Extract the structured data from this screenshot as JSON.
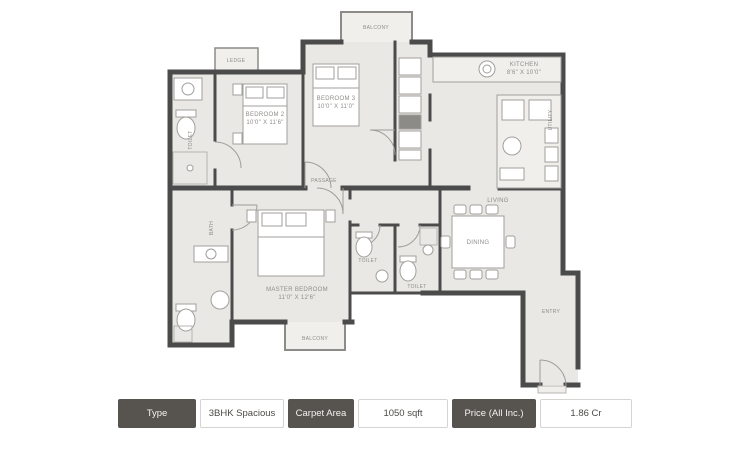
{
  "colors": {
    "wall": "#4b4b4b",
    "floor": "#e9e8e5",
    "balcony_floor": "#f0efec",
    "spec_cell_dark": "#57534f"
  },
  "plan": {
    "labels": {
      "balcony_top": "BALCONY",
      "ledge": "LEDGE",
      "bedroom2": {
        "name": "BEDROOM 2",
        "dims": "10'0\" X 11'6\""
      },
      "bedroom3": {
        "name": "BEDROOM 3",
        "dims": "10'0\" X 11'0\""
      },
      "kitchen": {
        "name": "KITCHEN",
        "dims": "8'6\" X 10'0\""
      },
      "utility": "UTILITY",
      "toilet_left": "TOILET",
      "bath": "BATH",
      "passage": "PASSAGE",
      "master": {
        "name": "MASTER BEDROOM",
        "dims": "11'0\" X 12'6\""
      },
      "toilet1": "TOILET",
      "toilet2": "TOILET",
      "dining": "DINING",
      "living": "LIVING",
      "entry": "ENTRY",
      "balcony_bottom": "BALCONY"
    }
  },
  "spec_table": {
    "cells": [
      {
        "label": "Type"
      },
      {
        "label": "3BHK Spacious"
      },
      {
        "label": "Carpet Area"
      },
      {
        "label": "1050 sqft"
      },
      {
        "label": "Price (All Inc.)"
      },
      {
        "label": "1.86 Cr"
      }
    ]
  }
}
